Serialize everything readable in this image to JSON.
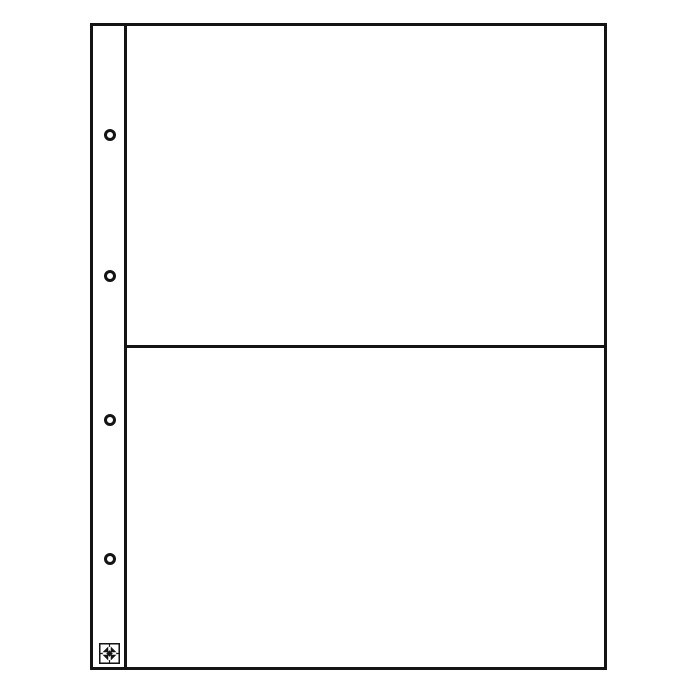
{
  "image": {
    "description_label": "two-pocket album page product photo",
    "background_color": "#ffffff",
    "line_color": "#141414"
  },
  "sheet": {
    "pocket_count": 2,
    "pockets": [
      {
        "label": "pocket-1"
      },
      {
        "label": "pocket-2"
      }
    ],
    "binding": {
      "hole_count": 4,
      "holes": [
        {
          "label": "punch-hole-1"
        },
        {
          "label": "punch-hole-2"
        },
        {
          "label": "punch-hole-3"
        },
        {
          "label": "punch-hole-4"
        }
      ],
      "logo_icon": "compass-diamond-logo-icon",
      "logo_colors": {
        "ink": "#141414",
        "paper": "#ffffff"
      }
    }
  }
}
